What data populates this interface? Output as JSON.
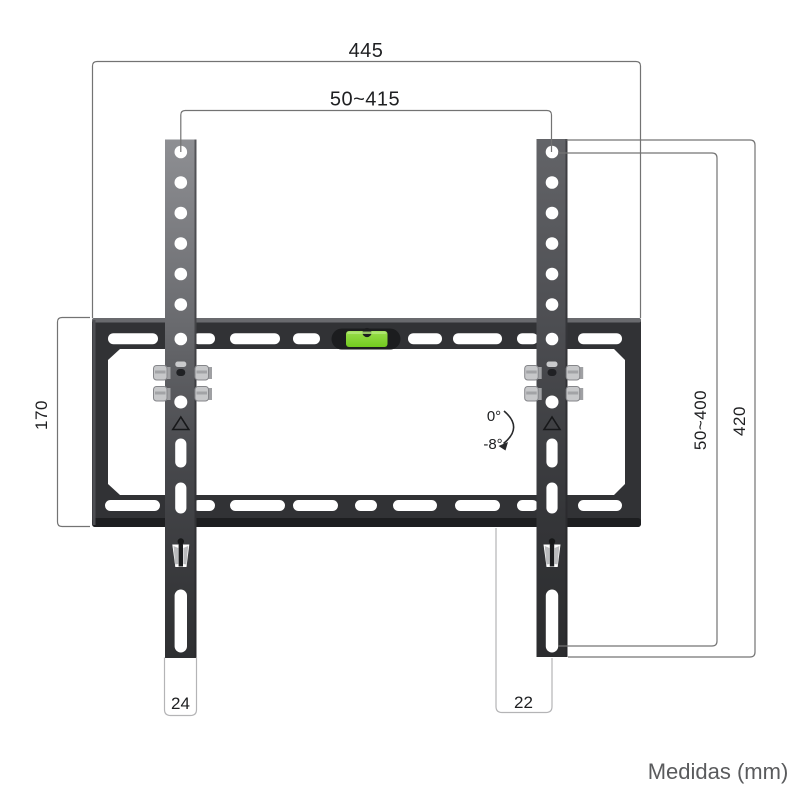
{
  "diagram_title": "TV wall mount dimensional drawing",
  "dimensions": {
    "total_width": "445",
    "vesa_width_range": "50~415",
    "plate_height": "170",
    "vesa_height_range": "50~400",
    "rail_height": "420",
    "left_rail_width": "24",
    "right_rail_width": "22"
  },
  "tilt": {
    "max_angle": "0°",
    "min_angle": "-8°"
  },
  "footer": {
    "units_label": "Medidas (mm)"
  },
  "colors": {
    "bracket_dark": "#313235",
    "rail_grey": "#6a6b6f",
    "level_green": "#7fd430",
    "dimension_line": "#737373",
    "label_box_border": "#b4b4b6",
    "text_dark": "#1e1f21",
    "footer_text": "#5a5b5d"
  }
}
